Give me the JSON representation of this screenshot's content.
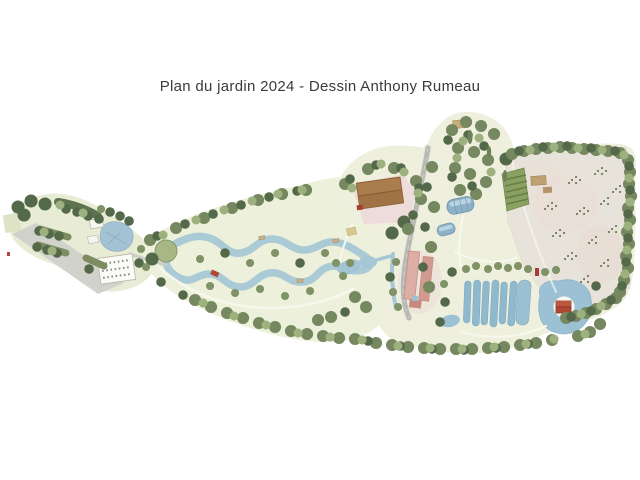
{
  "window": {
    "background": "#ffffff",
    "width": 640,
    "height": 480
  },
  "header": {
    "title": "Plan du jardin 2024 - Dessin Anthony Rumeau"
  },
  "map": {
    "type": "illustrated-garden-plan",
    "features": [
      "entrance-parking",
      "hedge-rows",
      "meandering-stream-loop",
      "red-footbridge",
      "wooden-footbridges",
      "main-barn",
      "pink-courtyard",
      "access-road",
      "greenhouse-tunnels",
      "farm-building",
      "vegetable-plot",
      "orchard-field",
      "sapling-clusters",
      "basin-ponds",
      "island-pavilion-pond",
      "tree-belts"
    ],
    "colors": {
      "title_ink": "#3b3b3b",
      "terrain": "#edf0da",
      "terrain_right": "#eef0dd",
      "terrain_left": "#e8ecd5",
      "field": "#e8e3da",
      "water": "#a6c7d6",
      "pond_blue": "#8fbace",
      "tree_dark": "#54694a",
      "tree_mid": "#75885f",
      "tree_light": "#9db17f",
      "road_gray": "#b7b9b2",
      "parking_gray": "#d0d1ca",
      "barn_brown": "#ab7d4d",
      "roof_red": "#ae4a34",
      "farm_pink": "#ddaea6",
      "courtyard_pink": "#eddcda",
      "greenhouse_blue": "#8db2c8",
      "page_bg": "#ffffff"
    }
  }
}
